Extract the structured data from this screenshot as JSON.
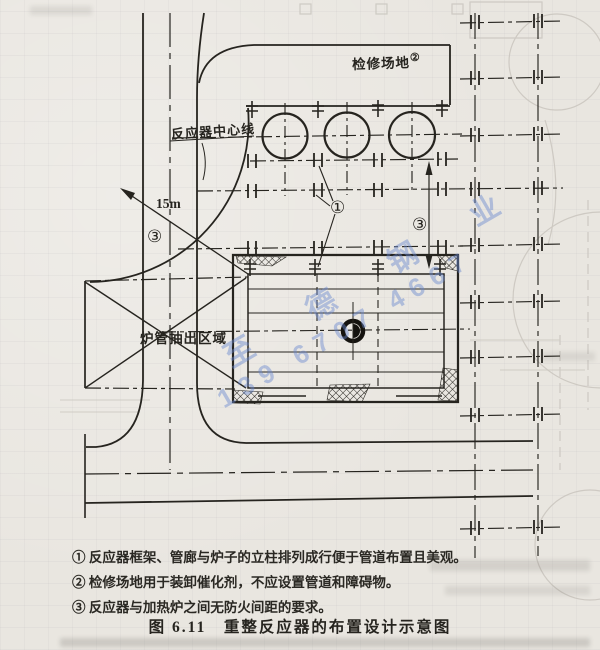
{
  "figure": {
    "caption": "图 6.11　重整反应器的布置设计示意图",
    "notes": [
      "① 反应器框架、管廊与炉子的立柱排列成行便于管道布置且美观。",
      "② 检修场地用于装卸催化剂，不应设置管道和障碍物。",
      "③ 反应器与加热炉之间无防火间距的要求。"
    ]
  },
  "labels": {
    "maintenance_area": "检修场地",
    "maintenance_ref": "②",
    "reactor_centerline": "反应器中心线",
    "radius_dim": "15m",
    "tube_pull_area": "炉管抽出区域",
    "callout_1": "①",
    "callout_3": "③"
  },
  "watermark": {
    "line1": "至 德 钢 业",
    "line2": "139 6707 4667",
    "color": "#6888ce"
  },
  "colors": {
    "paper": "#e9e6e0",
    "ink": "#26241f"
  }
}
